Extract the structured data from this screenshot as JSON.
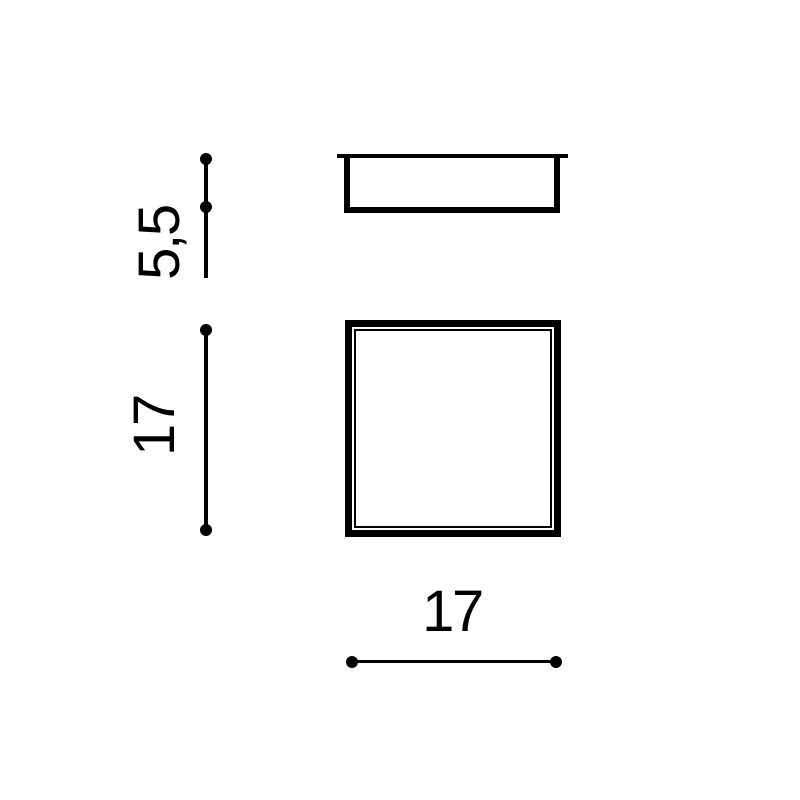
{
  "page": {
    "background_color": "#ffffff"
  },
  "drawing": {
    "kind": "technical-dimension-drawing",
    "stroke_color": "#000000",
    "views": {
      "side_view": {
        "id": "side-profile-with-flange"
      },
      "front_view": {
        "id": "square-face-with-inner-frame"
      }
    },
    "dimensions": {
      "height": {
        "label": "5,5",
        "orientation": "vertical"
      },
      "side": {
        "label": "17",
        "orientation": "vertical"
      },
      "width": {
        "label": "17",
        "orientation": "horizontal"
      }
    }
  }
}
